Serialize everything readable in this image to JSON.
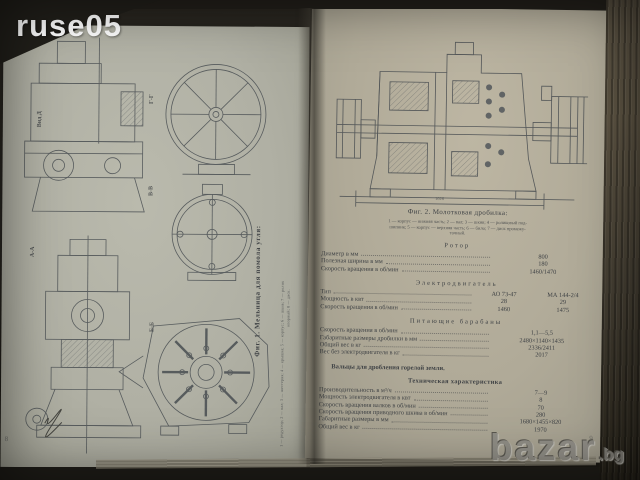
{
  "colors": {
    "paper_left": "#b0b0a4",
    "paper_right": "#b0aa98",
    "ink": "#3f4245",
    "background": "#2e2b25",
    "watermark_white": "#ffffff",
    "watermark_gray": "#8f8d86"
  },
  "watermarks": {
    "top_left": "ruse05",
    "bottom_right_main": "bazar",
    "bottom_right_suffix": ".bg"
  },
  "left_page": {
    "caption": "Фиг. 1. Мельница для помола угля:",
    "legend_line1": "1 — редуктор; 2 — вал; 3 — шестерня; 4 — крышка; 5 — корпус; 6 — шкив; 7 — ролик",
    "legend_line2": "опорный; 8 — диск.",
    "view_labels": {
      "vid_d": "Вид Д",
      "gg": "Г-Г",
      "vv": "В-В",
      "bb": "Б-Б",
      "aa": "А-А"
    },
    "page_number": "8"
  },
  "right_page": {
    "fig2_caption": "Фиг. 2. Молотковая дробилка:",
    "fig2_legend_line1": "1 — корпус — нижняя часть; 2 — вал; 3 — шкив; 4 — роликовый под-",
    "fig2_legend_line2": "шипник; 5 — корпус — верхняя часть; 6 — било; 7 — диск промежу-",
    "fig2_legend_line3": "точный.",
    "dim_label": "1026",
    "rotor": {
      "title": "Ротор",
      "rows": [
        {
          "label": "Диаметр в мм",
          "value": "800"
        },
        {
          "label": "Полезная ширина в мм",
          "value": "180"
        },
        {
          "label": "Скорость вращения в об/мин",
          "value": "1460/1470"
        }
      ]
    },
    "motor": {
      "title": "Электродвигатель",
      "type_label": "Тип",
      "col1": "АО 73-47",
      "col2": "МА 144-2/4",
      "rows": [
        {
          "label": "Мощность в квт",
          "v1": "28",
          "v2": "29"
        },
        {
          "label": "Скорость вращения в об/мин",
          "v1": "1460",
          "v2": "1475"
        }
      ]
    },
    "drums": {
      "title": "Питающие барабаны",
      "rows": [
        {
          "label": "Скорость вращения в об/мин",
          "value": "1,1—5,5"
        },
        {
          "label": "Габаритные размеры дробилки в мм",
          "value": "2480×1140×1435"
        },
        {
          "label": "Общий вес в кг",
          "value": "2336/2411"
        },
        {
          "label": "Вес без электродвигателя в кг",
          "value": "2017"
        }
      ]
    },
    "subheading": "Вальцы для дробления горелой земли.",
    "tech": {
      "title": "Техническая характеристика",
      "rows": [
        {
          "label": "Производительность в м³/ч",
          "value": "7—9"
        },
        {
          "label": "Мощность электродвигателя в квт",
          "value": "8"
        },
        {
          "label": "Скорость вращения валков в об/мин",
          "value": "70"
        },
        {
          "label": "Скорость вращения приводного шкива в об/мин",
          "value": "280"
        },
        {
          "label": "Габаритные размеры в мм",
          "value": "1680×1455×820"
        },
        {
          "label": "Общий вес в кг",
          "value": "1970"
        }
      ]
    },
    "page_number": "9"
  }
}
